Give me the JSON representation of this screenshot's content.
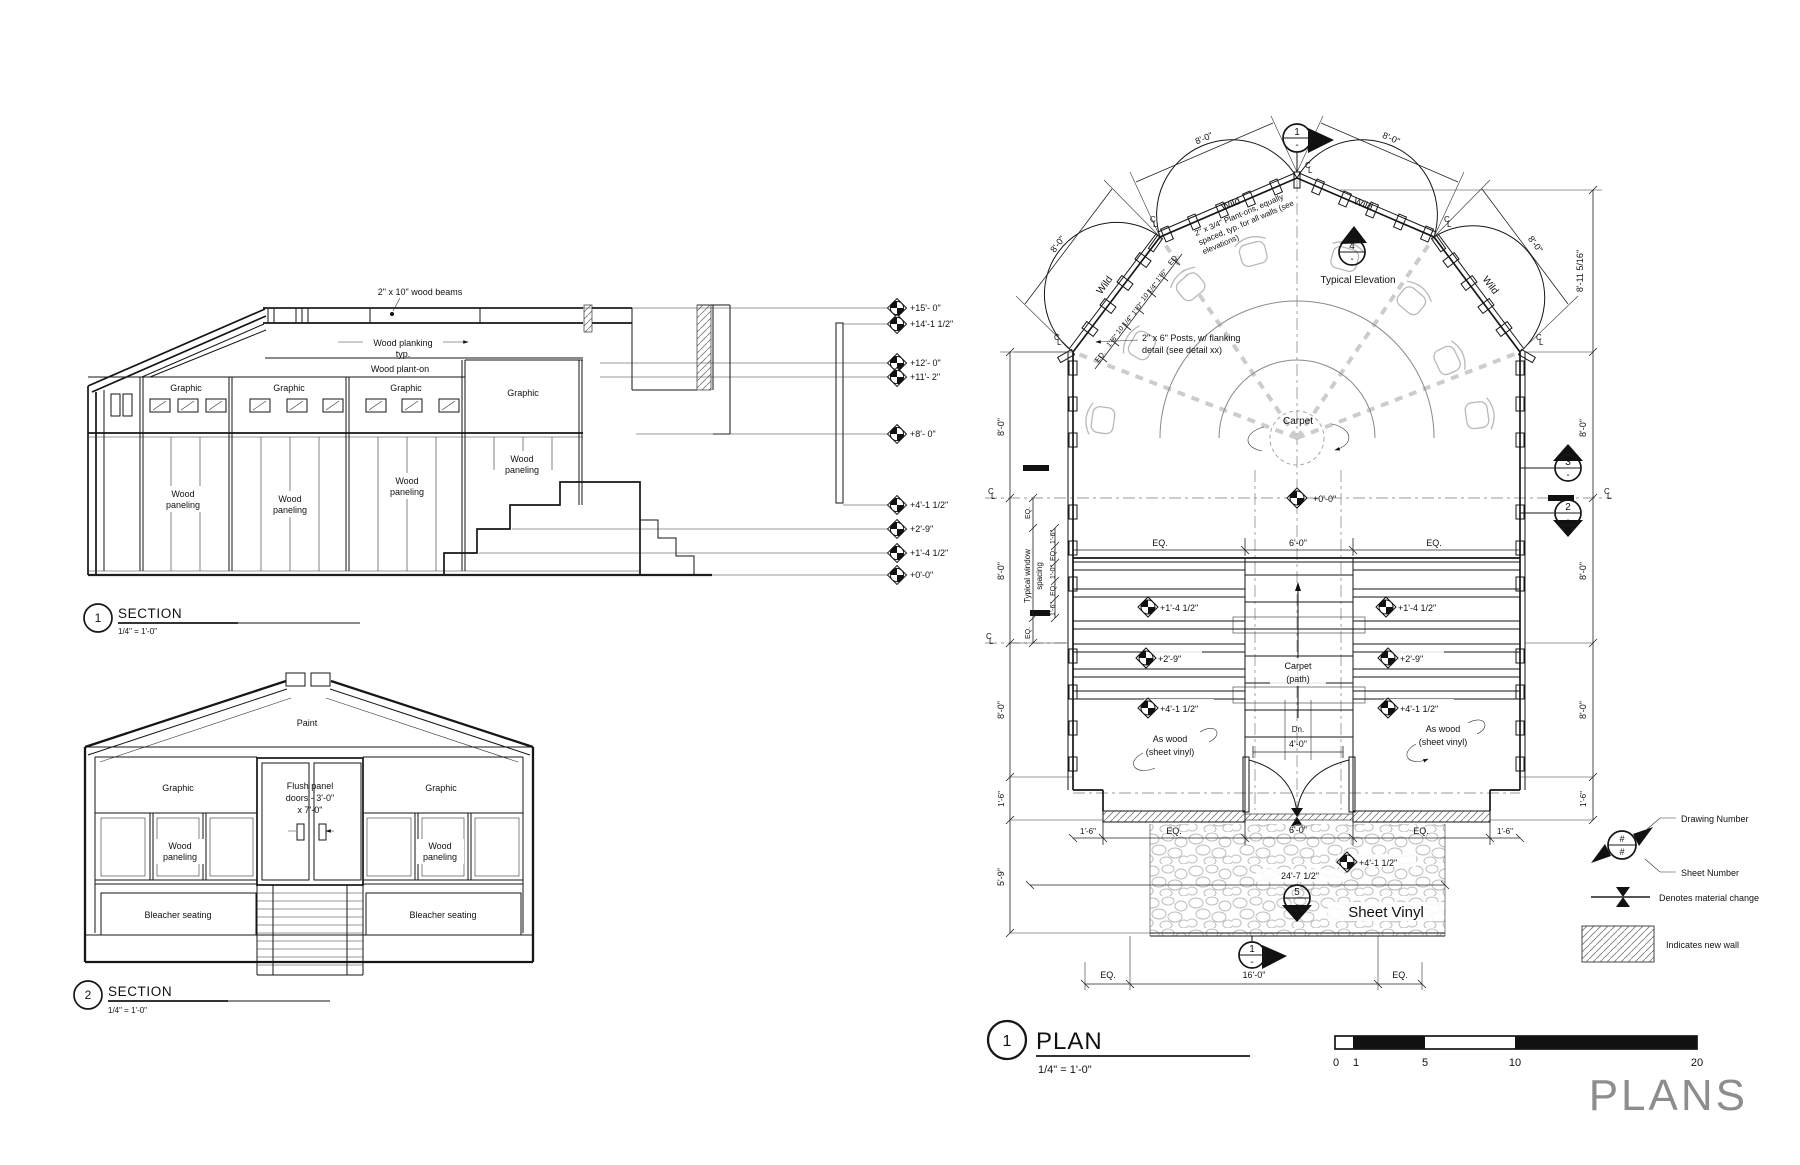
{
  "sheet": {
    "title": "PLANS"
  },
  "scalebar": {
    "labels": [
      "0",
      "1",
      "5",
      "10",
      "20"
    ]
  },
  "legend": {
    "hash": "#",
    "drawing_number": "Drawing Number",
    "sheet_number": "Sheet Number",
    "material_change": "Denotes material change",
    "new_wall": "Indicates new wall"
  },
  "section1": {
    "number": "1",
    "title": "SECTION",
    "scale": "1/4\" = 1'-0\"",
    "beams_note": "2\" x 10\" wood beams",
    "planking_1": "Wood planking",
    "planking_2": "typ.",
    "plant_on": "Wood plant-on",
    "graphic": "Graphic",
    "wood_1": "Wood",
    "wood_2": "paneling",
    "elevations": [
      "+15'- 0\"",
      "+14'-1 1/2\"",
      "+12'- 0\"",
      "+11'- 2\"",
      "+8'- 0\"",
      "+4'-1 1/2\"",
      "+2'-9\"",
      "+1'-4 1/2\"",
      "+0'-0\""
    ]
  },
  "section2": {
    "number": "2",
    "title": "SECTION",
    "scale": "1/4\" = 1'-0\"",
    "paint": "Paint",
    "graphic": "Graphic",
    "wood_1": "Wood",
    "wood_2": "paneling",
    "bleacher": "Bleacher seating",
    "door_1": "Flush panel",
    "door_2": "doors - 3'-0\"",
    "door_3": "x 7'-0\""
  },
  "plan": {
    "number": "1",
    "title": "PLAN",
    "scale": "1/4\" = 1'-0\"",
    "labels": {
      "wild": "Wild",
      "typical_elevation": "Typical Elevation",
      "planton_1": "2\" x 3/4\" Plant-ons, equally",
      "planton_2": "spaced, typ. for all walls (see",
      "planton_3": "elevations)",
      "posts_1": "2\" x 6\" Posts, w/ flanking",
      "posts_2": "detail (see detail xx)",
      "carpet": "Carpet",
      "path_1": "Carpet",
      "path_2": "(path)",
      "aswood_1": "As wood",
      "aswood_2": "(sheet vinyl)",
      "sheet_vinyl": "Sheet Vinyl",
      "dn": "Dn.",
      "winspace_1": "Typical window",
      "winspace_2": "spacing",
      "cl_c": "C",
      "cl_l": "L"
    },
    "dims": {
      "eq": "EQ.",
      "d4": "4'-0\"",
      "d6": "6'-0\"",
      "d8": "8'-0\"",
      "d16": "16'-0\"",
      "d24": "24'-7 1/2\"",
      "d1_6": "1'-6\"",
      "d5_9": "5'-9\"",
      "d1_0": "1'-0\"",
      "d10_25": "10 1/4\"",
      "d8_11": "8'-11 5/16\""
    },
    "elevs": {
      "e0": "+0'-0\"",
      "e1": "+1'-4 1/2\"",
      "e2": "+2'-9\"",
      "e4": "+4'-1 1/2\""
    },
    "markers": {
      "m1": "1",
      "m2": "2",
      "m3": "3",
      "m4": "4",
      "m5": "5",
      "dash": "-"
    }
  }
}
